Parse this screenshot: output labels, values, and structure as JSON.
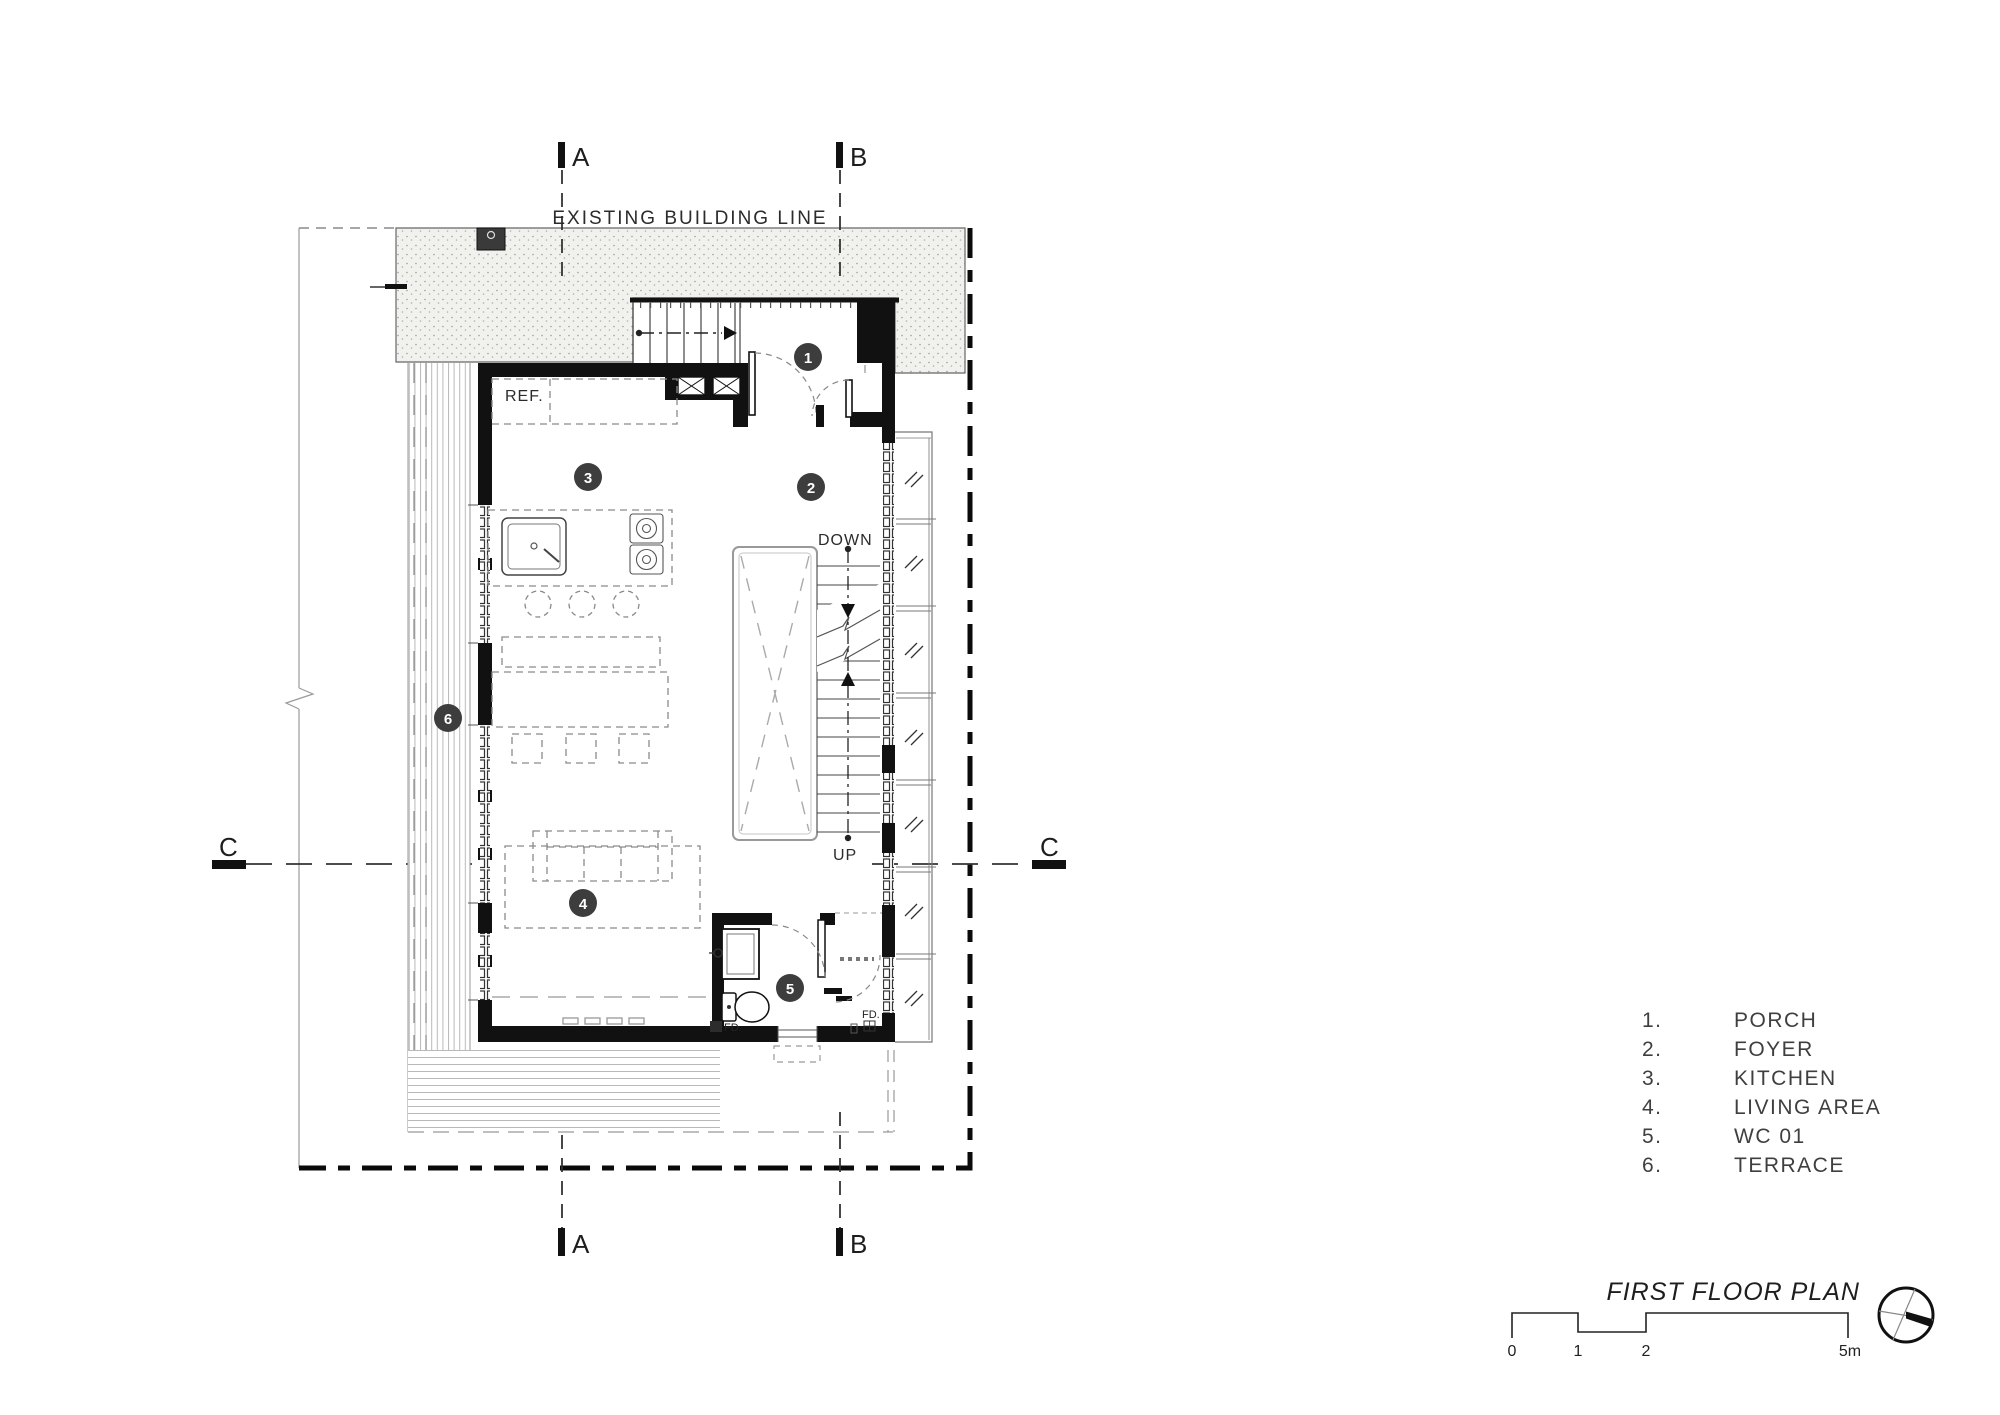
{
  "titleblock": {
    "title": "FIRST FLOOR PLAN"
  },
  "sections": {
    "a": "A",
    "b": "B",
    "c": "C"
  },
  "annotations": {
    "existing_building_line": "EXISTING BUILDING LINE",
    "refrigerator": "REF.",
    "down": "DOWN",
    "up": "UP",
    "floor_drain": "FD."
  },
  "rooms": {
    "badges": [
      "1",
      "2",
      "3",
      "4",
      "5",
      "6"
    ]
  },
  "legend": {
    "items": [
      {
        "num": "1.",
        "label": "PORCH"
      },
      {
        "num": "2.",
        "label": "FOYER"
      },
      {
        "num": "3.",
        "label": "KITCHEN"
      },
      {
        "num": "4.",
        "label": "LIVING AREA"
      },
      {
        "num": "5.",
        "label": "WC 01"
      },
      {
        "num": "6.",
        "label": "TERRACE"
      }
    ]
  },
  "scale_bar": {
    "ticks": [
      "0",
      "1",
      "2",
      "5m"
    ]
  },
  "colors": {
    "ink": "#111111",
    "badge": "#3d3d3d",
    "line_gray": "#777777",
    "hatch_bg": "#f1f1ee",
    "dashed_gray": "#8a8a8a"
  }
}
